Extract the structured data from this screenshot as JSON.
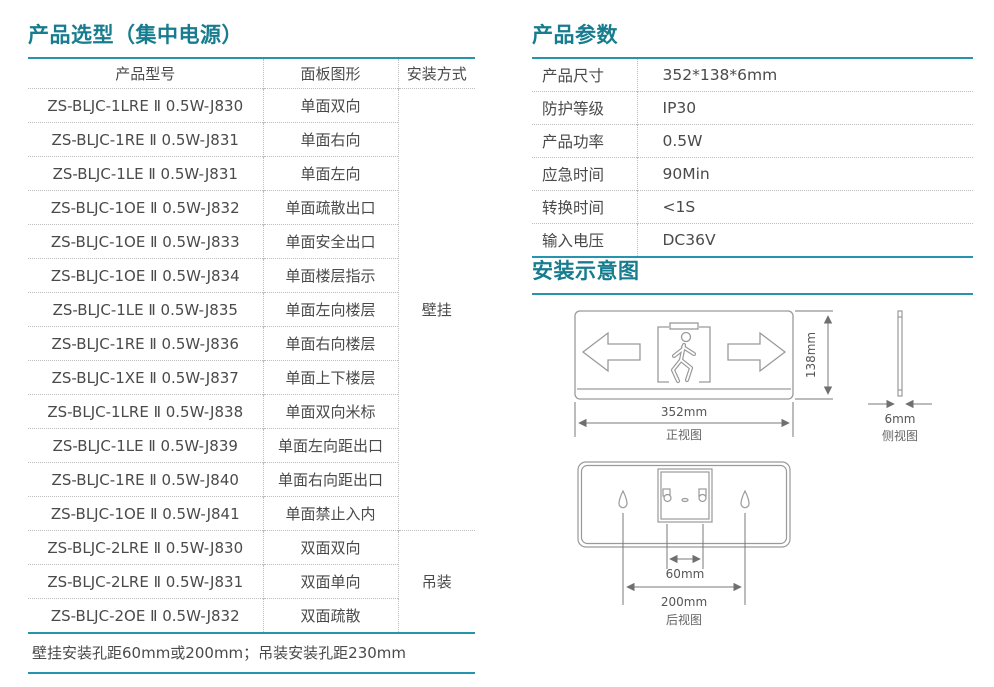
{
  "selection_table": {
    "title": "产品选型（集中电源）",
    "columns": [
      "产品型号",
      "面板图形",
      "安装方式"
    ],
    "rows": [
      {
        "model": "ZS-BLJC-1LRE Ⅱ 0.5W-J830",
        "panel": "单面双向"
      },
      {
        "model": "ZS-BLJC-1RE Ⅱ 0.5W-J831",
        "panel": "单面右向"
      },
      {
        "model": "ZS-BLJC-1LE Ⅱ 0.5W-J831",
        "panel": "单面左向"
      },
      {
        "model": "ZS-BLJC-1OE Ⅱ 0.5W-J832",
        "panel": "单面疏散出口"
      },
      {
        "model": "ZS-BLJC-1OE Ⅱ 0.5W-J833",
        "panel": "单面安全出口"
      },
      {
        "model": "ZS-BLJC-1OE Ⅱ 0.5W-J834",
        "panel": "单面楼层指示"
      },
      {
        "model": "ZS-BLJC-1LE Ⅱ 0.5W-J835",
        "panel": "单面左向楼层"
      },
      {
        "model": "ZS-BLJC-1RE Ⅱ 0.5W-J836",
        "panel": "单面右向楼层"
      },
      {
        "model": "ZS-BLJC-1XE Ⅱ 0.5W-J837",
        "panel": "单面上下楼层"
      },
      {
        "model": "ZS-BLJC-1LRE Ⅱ 0.5W-J838",
        "panel": "单面双向米标"
      },
      {
        "model": "ZS-BLJC-1LE Ⅱ 0.5W-J839",
        "panel": "单面左向距出口"
      },
      {
        "model": "ZS-BLJC-1RE Ⅱ 0.5W-J840",
        "panel": "单面右向距出口"
      },
      {
        "model": "ZS-BLJC-1OE Ⅱ 0.5W-J841",
        "panel": "单面禁止入内"
      },
      {
        "model": "ZS-BLJC-2LRE Ⅱ 0.5W-J830",
        "panel": "双面双向"
      },
      {
        "model": "ZS-BLJC-2LRE Ⅱ 0.5W-J831",
        "panel": "双面单向"
      },
      {
        "model": "ZS-BLJC-2OE Ⅱ 0.5W-J832",
        "panel": "双面疏散"
      }
    ],
    "mount_groups": [
      {
        "label": "壁挂",
        "span": 13
      },
      {
        "label": "吊装",
        "span": 3
      }
    ],
    "footnote": "壁挂安装孔距60mm或200mm；吊装安装孔距230mm"
  },
  "parameters": {
    "title": "产品参数",
    "rows": [
      {
        "label": "产品尺寸",
        "value": "352*138*6mm"
      },
      {
        "label": "防护等级",
        "value": "IP30"
      },
      {
        "label": "产品功率",
        "value": "0.5W"
      },
      {
        "label": "应急时间",
        "value": "90Min"
      },
      {
        "label": "转换时间",
        "value": "<1S"
      },
      {
        "label": "输入电压",
        "value": "DC36V"
      }
    ]
  },
  "installation": {
    "title": "安装示意图",
    "front_view": {
      "width_label": "352mm",
      "height_label": "138mm",
      "caption": "正视图"
    },
    "side_view": {
      "thickness_label": "6mm",
      "caption": "侧视图"
    },
    "rear_view": {
      "inner_hole_spacing": "60mm",
      "outer_hole_spacing": "200mm",
      "caption": "后视图"
    }
  },
  "colors": {
    "heading": "#177c8e",
    "rule": "#2694af",
    "text": "#4a4a4a",
    "diagram_stroke": "#9a9a9a"
  }
}
